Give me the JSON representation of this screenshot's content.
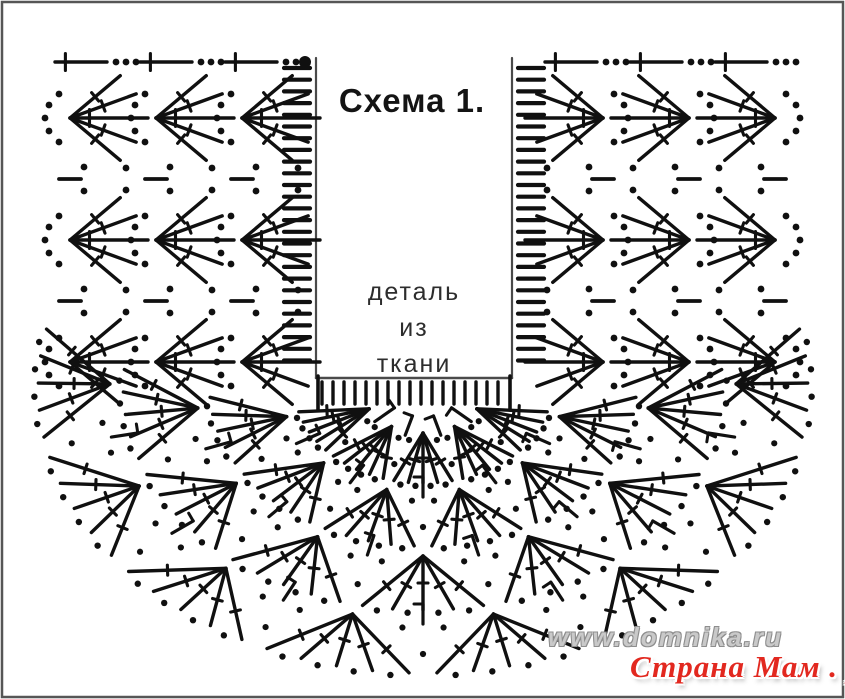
{
  "title": "Схема 1.",
  "fabric_label": {
    "line1": "деталь",
    "line2": "из",
    "line3": "ткани"
  },
  "watermarks": {
    "site": "www.domnika.ru",
    "brand": "Страна Мам . ру"
  },
  "colors": {
    "background": "#ffffff",
    "ink": "#101010",
    "frame": "#565656",
    "rect_border": "#4a4a4a",
    "title_text": "#141414",
    "label_text": "#2d2d2d",
    "watermark_gray": "#c9c9c9",
    "watermark_gray_outline": "#8e8e8e",
    "watermark_red": "#e2281f"
  },
  "diagram": {
    "type": "crochet-chart",
    "canvas": {
      "width": 845,
      "height": 699
    },
    "fabric_rect": {
      "x": 316,
      "y": 58,
      "width": 196,
      "height": 320
    },
    "start_dot": {
      "x": 305,
      "y": 62,
      "r": 6
    },
    "top_row": {
      "y": 62,
      "left_span": [
        55,
        316
      ],
      "right_span": [
        545,
        801
      ],
      "unit": {
        "period": 85,
        "line_len": 52,
        "dots": 3
      }
    },
    "ladders": [
      {
        "x": 297,
        "y1": 68,
        "y2": 372,
        "step": 11.7,
        "dash_len": 26
      },
      {
        "x": 531,
        "y1": 68,
        "y2": 372,
        "step": 11.7,
        "dash_len": 26
      }
    ],
    "comb": {
      "x1": 322,
      "x2": 508,
      "y1": 382,
      "y2": 404,
      "step": 11
    },
    "side_columns": {
      "left_bases": [
        62,
        148,
        234
      ],
      "right_bases": [
        783,
        697,
        611
      ],
      "shell_rows_y": [
        118,
        240,
        362
      ],
      "gap_rows_y": [
        179,
        301
      ],
      "stem_len": 78,
      "stems_per_shell": 5,
      "spread_deg": 72
    },
    "bottom_center": {
      "cx": 423,
      "cy": 388,
      "kx": 1.35
    },
    "bottom_rows": [
      {
        "base_r": 45,
        "tip_r": 95,
        "start_deg": 192,
        "end_deg": 348,
        "fans": 5
      },
      {
        "base_r": 105,
        "tip_r": 158,
        "start_deg": 181,
        "end_deg": 359,
        "fans": 6
      },
      {
        "base_r": 168,
        "tip_r": 222,
        "start_deg": 173,
        "end_deg": 367,
        "fans": 7
      },
      {
        "base_r": 232,
        "tip_r": 285,
        "start_deg": 166,
        "end_deg": 374,
        "fans": 8
      }
    ],
    "symbols": {
      "dot": "chain-stitch",
      "stem-with-cross": "treble-crochet",
      "dash": "chain-bar",
      "t-post": "single-crochet-post",
      "comb-tick": "edge-stitch",
      "ladder-dash": "turning-chain",
      "big-dot": "start-point"
    }
  }
}
